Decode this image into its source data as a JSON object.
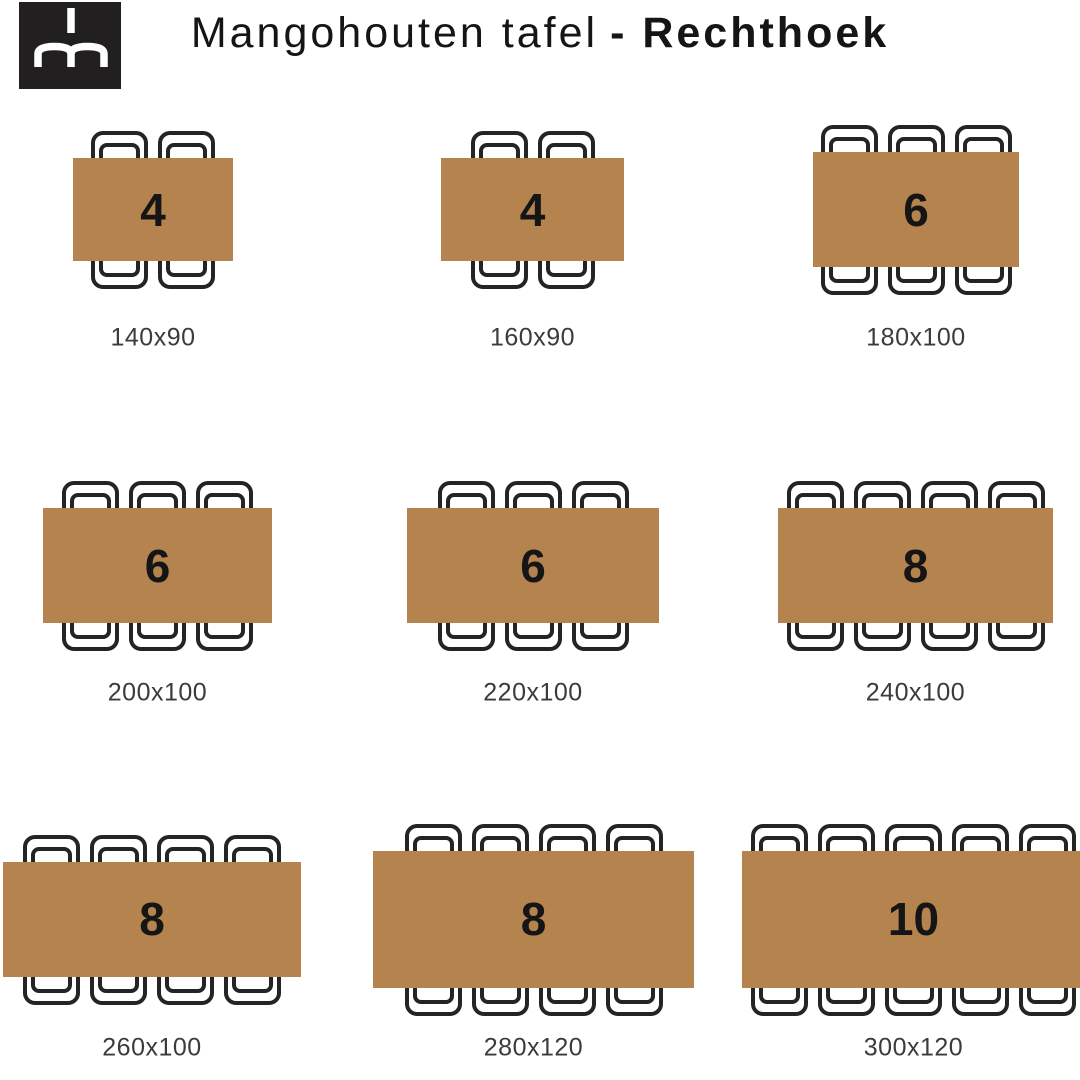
{
  "header": {
    "logo_monogram": "mh",
    "title_regular": "Mangohouten tafel",
    "title_bold": "- Rechthoek"
  },
  "colors": {
    "background": "#ffffff",
    "table_fill": "#b4834e",
    "chair_outline": "#242424",
    "seat_number": "#151515",
    "size_label": "#3b3b3b",
    "title_text": "#151515",
    "logo_background": "#211f20",
    "logo_mark": "#ffffff"
  },
  "tables": [
    {
      "seats": "4",
      "size_label": "140x90",
      "width_cm": 140,
      "depth_cm": 90,
      "chairs_per_side": 2,
      "layout": {
        "cx": 153,
        "cy": 209.5,
        "label_y": 338
      }
    },
    {
      "seats": "4",
      "size_label": "160x90",
      "width_cm": 160,
      "depth_cm": 90,
      "chairs_per_side": 2,
      "layout": {
        "cx": 532.5,
        "cy": 209.5,
        "label_y": 338
      }
    },
    {
      "seats": "6",
      "size_label": "180x100",
      "width_cm": 180,
      "depth_cm": 100,
      "chairs_per_side": 3,
      "layout": {
        "cx": 916,
        "cy": 209.5,
        "label_y": 338
      }
    },
    {
      "seats": "6",
      "size_label": "200x100",
      "width_cm": 200,
      "depth_cm": 100,
      "chairs_per_side": 3,
      "layout": {
        "cx": 157.5,
        "cy": 565.5,
        "label_y": 693
      }
    },
    {
      "seats": "6",
      "size_label": "220x100",
      "width_cm": 220,
      "depth_cm": 100,
      "chairs_per_side": 3,
      "layout": {
        "cx": 533,
        "cy": 565.5,
        "label_y": 693
      }
    },
    {
      "seats": "8",
      "size_label": "240x100",
      "width_cm": 240,
      "depth_cm": 100,
      "chairs_per_side": 4,
      "layout": {
        "cx": 915.5,
        "cy": 565.5,
        "label_y": 693
      }
    },
    {
      "seats": "8",
      "size_label": "260x100",
      "width_cm": 260,
      "depth_cm": 100,
      "chairs_per_side": 4,
      "layout": {
        "cx": 152,
        "cy": 919,
        "label_y": 1048
      }
    },
    {
      "seats": "8",
      "size_label": "280x120",
      "width_cm": 280,
      "depth_cm": 120,
      "chairs_per_side": 4,
      "layout": {
        "cx": 533.5,
        "cy": 919,
        "label_y": 1048
      }
    },
    {
      "seats": "10",
      "size_label": "300x120",
      "width_cm": 300,
      "depth_cm": 120,
      "chairs_per_side": 5,
      "layout": {
        "cx": 913.5,
        "cy": 919,
        "label_y": 1048
      }
    }
  ],
  "layout_hints": {
    "px_per_cm": 1.145,
    "chair": {
      "width": 57,
      "height": 80,
      "gap": 10,
      "top_overhang": 27,
      "bottom_overhang": 28
    }
  }
}
